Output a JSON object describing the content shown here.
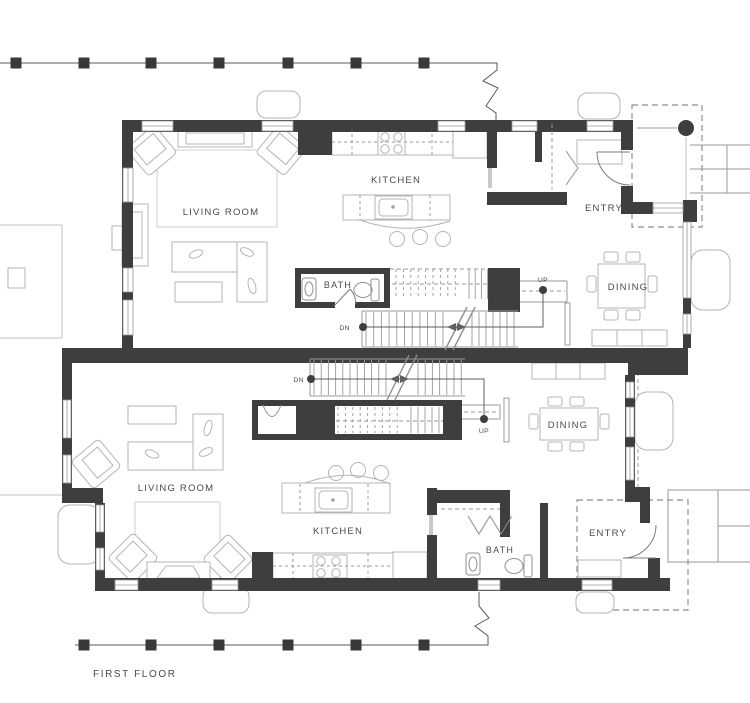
{
  "title_label": {
    "text": "FIRST FLOOR",
    "x": 93,
    "y": 677
  },
  "colors": {
    "wall": "#3e3e3e",
    "post": "#383838",
    "fence_line": "#5a5a5a",
    "furniture": "#b4b4b4",
    "rug": "#cfcfcf",
    "tread": "#9a9a9a",
    "window": "#9a9a9a",
    "dash": "#8f8f8f",
    "text": "#4a4a4a",
    "site": "#c2c2c2"
  },
  "room_labels": [
    {
      "id": "a-kitchen",
      "text": "KITCHEN",
      "x": 396,
      "y": 183,
      "size": 9.5
    },
    {
      "id": "a-entry",
      "text": "ENTRY",
      "x": 604,
      "y": 211,
      "size": 9.5
    },
    {
      "id": "a-living",
      "text": "LIVING ROOM",
      "x": 221,
      "y": 215,
      "size": 9.5
    },
    {
      "id": "a-bath",
      "text": "BATH",
      "x": 338,
      "y": 288,
      "size": 9
    },
    {
      "id": "a-dining",
      "text": "DINING",
      "x": 628,
      "y": 290,
      "size": 9.5
    },
    {
      "id": "b-dining",
      "text": "DINING",
      "x": 568,
      "y": 428,
      "size": 9.5
    },
    {
      "id": "b-living",
      "text": "LIVING ROOM",
      "x": 176,
      "y": 491,
      "size": 9.5
    },
    {
      "id": "b-kitchen",
      "text": "KITCHEN",
      "x": 338,
      "y": 534,
      "size": 9.5
    },
    {
      "id": "b-bath",
      "text": "BATH",
      "x": 500,
      "y": 553,
      "size": 9
    },
    {
      "id": "b-entry",
      "text": "ENTRY",
      "x": 608,
      "y": 536,
      "size": 9.5
    }
  ],
  "nav_labels": [
    {
      "id": "a-dn",
      "text": "DN",
      "x": 350,
      "y": 330,
      "anchor": "end",
      "dot": {
        "x": 363,
        "y": 327
      }
    },
    {
      "id": "a-up",
      "text": "UP",
      "x": 543,
      "y": 282,
      "anchor": "middle",
      "dot": {
        "x": 543,
        "y": 290
      }
    },
    {
      "id": "b-dn",
      "text": "DN",
      "x": 304,
      "y": 382,
      "anchor": "end",
      "dot": {
        "x": 311,
        "y": 379
      }
    },
    {
      "id": "b-up",
      "text": "UP",
      "x": 484,
      "y": 433,
      "anchor": "middle",
      "dot": {
        "x": 484,
        "y": 419
      }
    }
  ],
  "fence_top": {
    "y": 63,
    "x_start": 0,
    "x_end": 456,
    "post_size": 11,
    "posts": [
      16,
      84,
      151,
      219,
      288,
      356,
      424
    ],
    "break_path": "M456,63 H497 V70 L483,81 L498,88 L486,106 L496,113 V120"
  },
  "fence_bottom": {
    "y": 645,
    "x_start": 75,
    "x_end": 456,
    "post_size": 11,
    "posts": [
      84,
      151,
      219,
      288,
      356,
      424
    ],
    "break_path": "M456,645 H488 V636 L475,626 L489,618 L479,606 V592"
  },
  "windows": [
    {
      "x": 142,
      "y": 121,
      "w": 31,
      "h": 10,
      "o": "h"
    },
    {
      "x": 262,
      "y": 121,
      "w": 31,
      "h": 10,
      "o": "h"
    },
    {
      "x": 438,
      "y": 121,
      "w": 27,
      "h": 10,
      "o": "h"
    },
    {
      "x": 512,
      "y": 121,
      "w": 25,
      "h": 10,
      "o": "h"
    },
    {
      "x": 587,
      "y": 121,
      "w": 26,
      "h": 10,
      "o": "h"
    },
    {
      "x": 123,
      "y": 168,
      "w": 10,
      "h": 34,
      "o": "v"
    },
    {
      "x": 123,
      "y": 268,
      "w": 10,
      "h": 24,
      "o": "v"
    },
    {
      "x": 123,
      "y": 300,
      "w": 10,
      "h": 35,
      "o": "v"
    },
    {
      "x": 683,
      "y": 222,
      "w": 8,
      "h": 76,
      "o": "v"
    },
    {
      "x": 683,
      "y": 314,
      "w": 8,
      "h": 20,
      "o": "v"
    },
    {
      "x": 653,
      "y": 203,
      "w": 30,
      "h": 10,
      "o": "h"
    },
    {
      "x": 115,
      "y": 580,
      "w": 23,
      "h": 10,
      "o": "h"
    },
    {
      "x": 212,
      "y": 580,
      "w": 26,
      "h": 10,
      "o": "h"
    },
    {
      "x": 478,
      "y": 580,
      "w": 22,
      "h": 10,
      "o": "h"
    },
    {
      "x": 582,
      "y": 580,
      "w": 30,
      "h": 10,
      "o": "h"
    },
    {
      "x": 63,
      "y": 400,
      "w": 8,
      "h": 38,
      "o": "v"
    },
    {
      "x": 63,
      "y": 455,
      "w": 8,
      "h": 28,
      "o": "v"
    },
    {
      "x": 96,
      "y": 505,
      "w": 8,
      "h": 27,
      "o": "v"
    },
    {
      "x": 96,
      "y": 548,
      "w": 8,
      "h": 22,
      "o": "v"
    },
    {
      "x": 626,
      "y": 382,
      "w": 8,
      "h": 16,
      "o": "v"
    },
    {
      "x": 626,
      "y": 407,
      "w": 8,
      "h": 30,
      "o": "v"
    },
    {
      "x": 626,
      "y": 447,
      "w": 8,
      "h": 33,
      "o": "v"
    }
  ],
  "flights": [
    {
      "id": "a-upper-dashed",
      "x1": 396,
      "x2": 462,
      "step": 7.4,
      "y1": 269,
      "y2": 299,
      "dash": true
    },
    {
      "id": "a-upper-solid",
      "x1": 469,
      "x2": 488,
      "step": 6.2,
      "y1": 269,
      "y2": 299,
      "dash": false
    },
    {
      "id": "a-lower-left",
      "x1": 366,
      "x2": 443,
      "step": 7.7,
      "y1": 312,
      "y2": 346,
      "dash": false
    },
    {
      "id": "a-lower-right",
      "x1": 472,
      "x2": 515,
      "step": 7.0,
      "y1": 312,
      "y2": 346,
      "dash": false
    },
    {
      "id": "b-lower-left",
      "x1": 314,
      "x2": 386,
      "step": 7.2,
      "y1": 360,
      "y2": 395,
      "dash": false
    },
    {
      "id": "b-lower-right",
      "x1": 418,
      "x2": 462,
      "step": 7.2,
      "y1": 360,
      "y2": 395,
      "dash": false
    },
    {
      "id": "b-upper-dashed",
      "x1": 338,
      "x2": 404,
      "step": 7.4,
      "y1": 407,
      "y2": 433,
      "dash": true
    },
    {
      "id": "b-upper-solid",
      "x1": 411,
      "x2": 440,
      "step": 7.0,
      "y1": 407,
      "y2": 433,
      "dash": false
    }
  ],
  "stools_a": [
    {
      "x": 397,
      "y": 239
    },
    {
      "x": 420,
      "y": 237
    },
    {
      "x": 443,
      "y": 239
    }
  ],
  "stools_b": [
    {
      "x": 336,
      "y": 473
    },
    {
      "x": 358,
      "y": 470
    },
    {
      "x": 381,
      "y": 473
    }
  ],
  "burners_a": [
    {
      "x": 385,
      "y": 137
    },
    {
      "x": 398,
      "y": 137
    },
    {
      "x": 385,
      "y": 149
    },
    {
      "x": 398,
      "y": 149
    }
  ],
  "burners_b": [
    {
      "x": 321,
      "y": 561
    },
    {
      "x": 336,
      "y": 561
    },
    {
      "x": 321,
      "y": 573
    },
    {
      "x": 336,
      "y": 573
    }
  ]
}
